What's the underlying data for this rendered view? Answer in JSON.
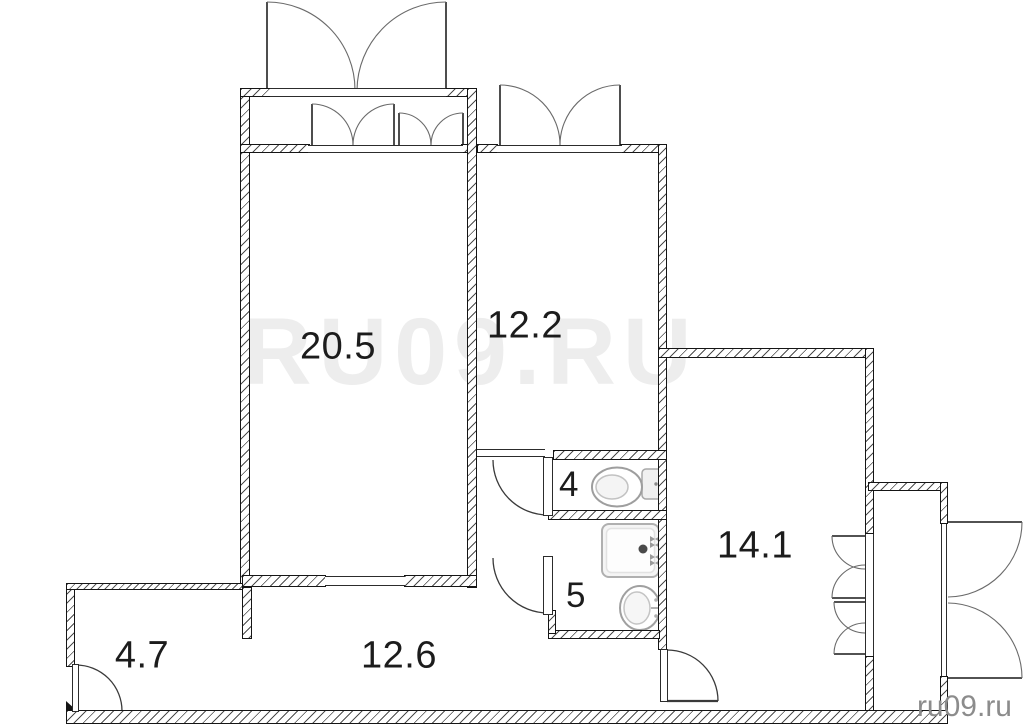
{
  "floorplan": {
    "watermark": "RU09.RU",
    "credit": "ru09.ru",
    "rooms": [
      {
        "name": "living-room",
        "area_label": "20.5"
      },
      {
        "name": "bedroom",
        "area_label": "12.2"
      },
      {
        "name": "kitchen",
        "area_label": "14.1"
      },
      {
        "name": "entry",
        "area_label": "4.7"
      },
      {
        "name": "hallway",
        "area_label": "12.6"
      },
      {
        "name": "wc",
        "area_label": "4"
      },
      {
        "name": "bathroom",
        "area_label": "5"
      }
    ],
    "colors": {
      "wall_line": "#151515",
      "hatch": "#4d4d4d",
      "door_arc": "#3a3a3a",
      "fixture": "#a0a0a0",
      "watermark": "#ededed",
      "credit": "#8c8c8c",
      "label": "#1c1c1c"
    }
  }
}
